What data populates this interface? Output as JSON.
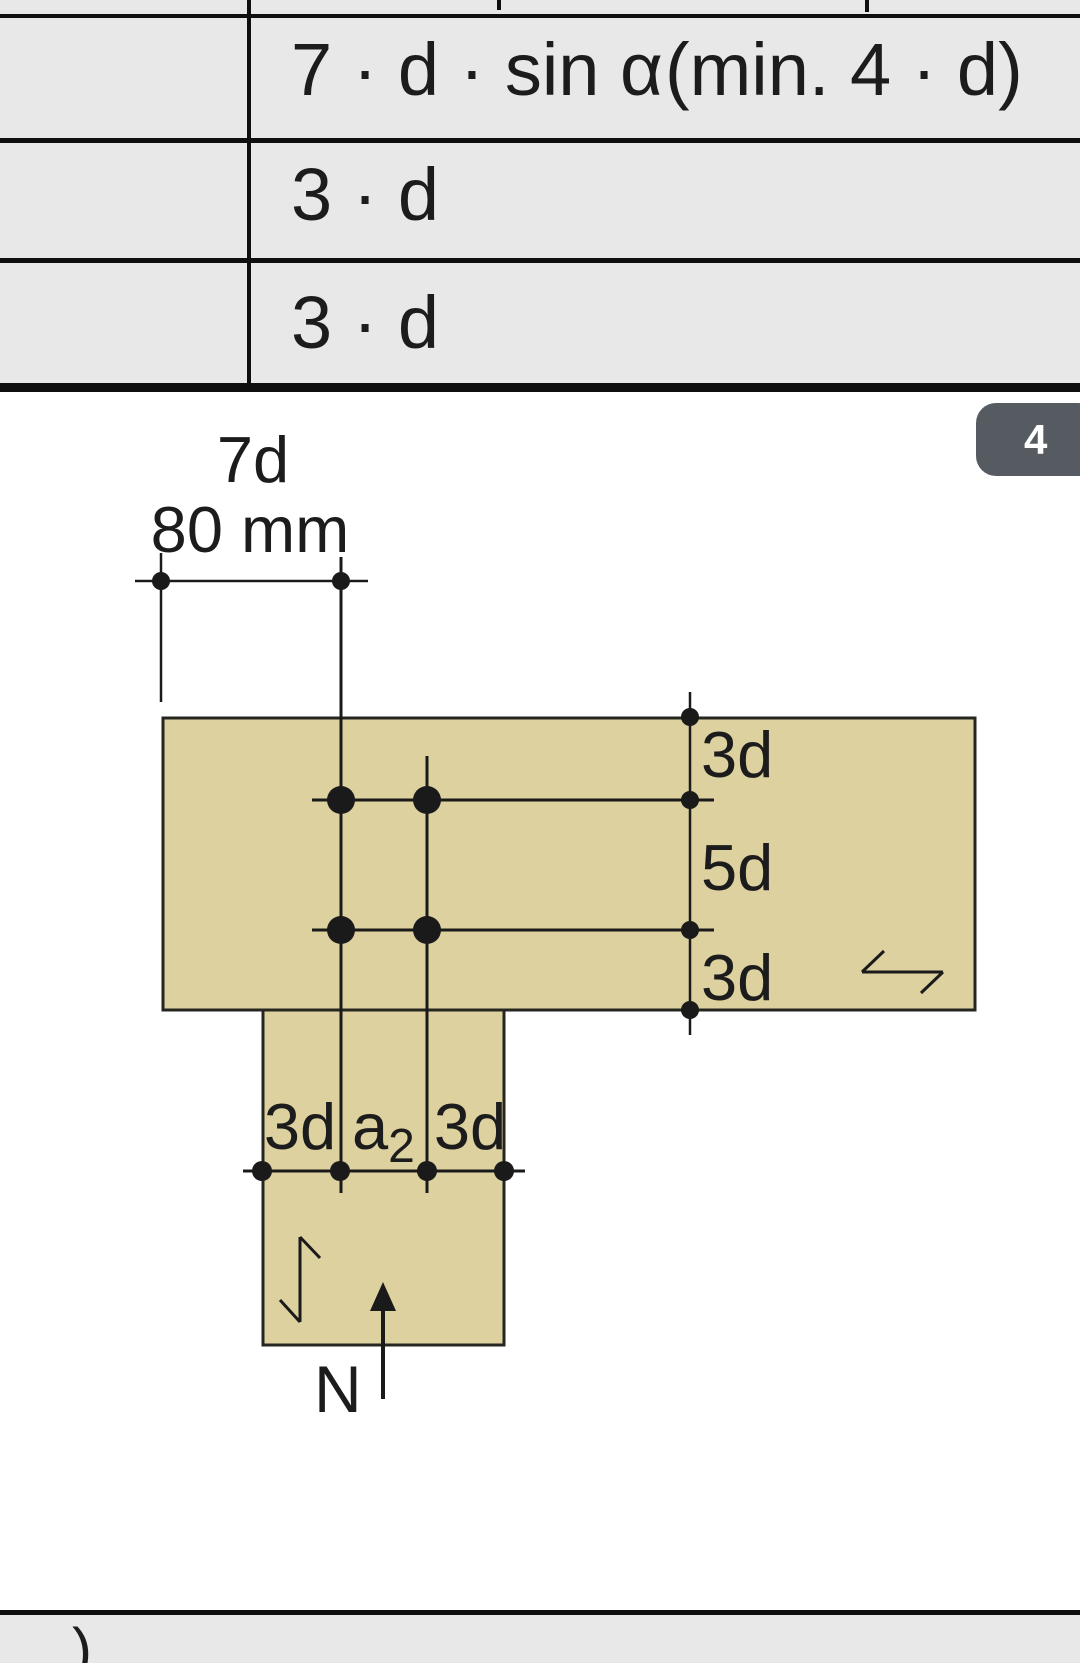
{
  "colors": {
    "table_bg": "#e8e8e8",
    "line": "#0f0f0f",
    "wood": "#ddd1a0",
    "badge_bg": "#565b62"
  },
  "table": {
    "rows": [
      {
        "value": "7 · d · sin α",
        "note": "(min. 4 · d)"
      },
      {
        "value": "3 · d",
        "note": ""
      },
      {
        "value": "3 · d",
        "note": ""
      }
    ]
  },
  "page_badge": {
    "number": "4"
  },
  "diagram": {
    "top_dimension": {
      "line1": "7d",
      "line2": "80 mm"
    },
    "right_dimensions": {
      "edge_top": "3d",
      "middle": "5d",
      "edge_bottom": "3d"
    },
    "bottom_dimensions": {
      "left": "3d",
      "mid_base": "a",
      "mid_sub": "2",
      "right": "3d"
    },
    "force_label": "N"
  },
  "footer": {
    "cut_text": ")"
  }
}
